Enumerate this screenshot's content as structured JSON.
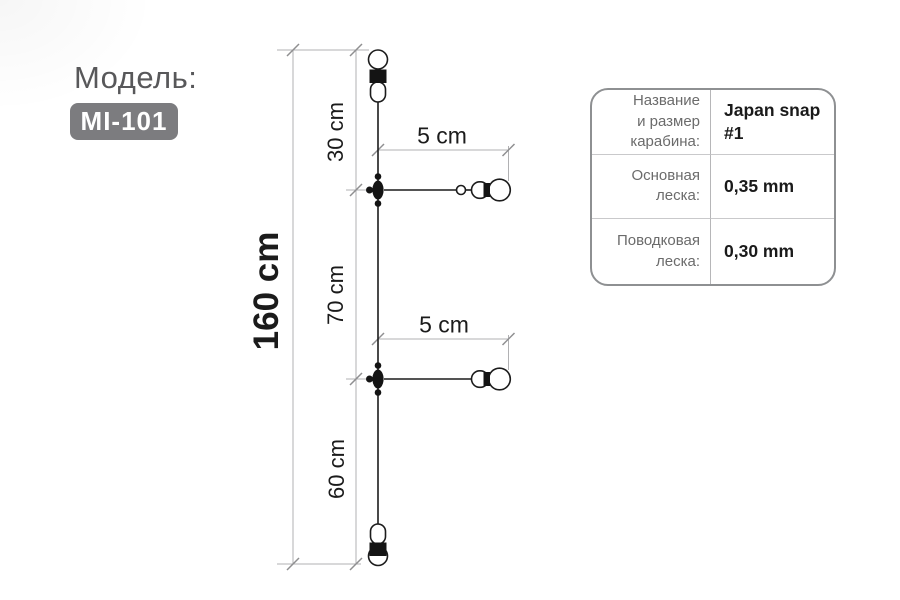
{
  "model": {
    "label": "Модель:",
    "code": "MI-101"
  },
  "diagram": {
    "total_label": "160 cm",
    "segment_labels": [
      "30 cm",
      "70 cm",
      "60 cm"
    ],
    "branch_labels": [
      "5 cm",
      "5 cm"
    ],
    "parts": [
      "barrel-swivel-top",
      "snap-swivel-branch-1",
      "snap-swivel-branch-2",
      "barrel-swivel-bottom"
    ]
  },
  "spec_table": {
    "rows": [
      {
        "label": "Название\nи размер\nкарабина:",
        "value": "Japan snap\n#1"
      },
      {
        "label": "Основная\nлеска:",
        "value": "0,35 mm"
      },
      {
        "label": "Поводковая\nлеска:",
        "value": "0,30 mm"
      }
    ]
  },
  "colors": {
    "badge_bg": "#7c7c7f",
    "badge_text": "#ffffff",
    "model_label_text": "#58585a",
    "diagram_line": "#1c1c1c",
    "dimension_line": "#b1b1b3",
    "table_border": "#8e9092",
    "table_label_text": "#6b6b6b",
    "table_value_text": "#1a1a1a",
    "background": "#ffffff"
  }
}
